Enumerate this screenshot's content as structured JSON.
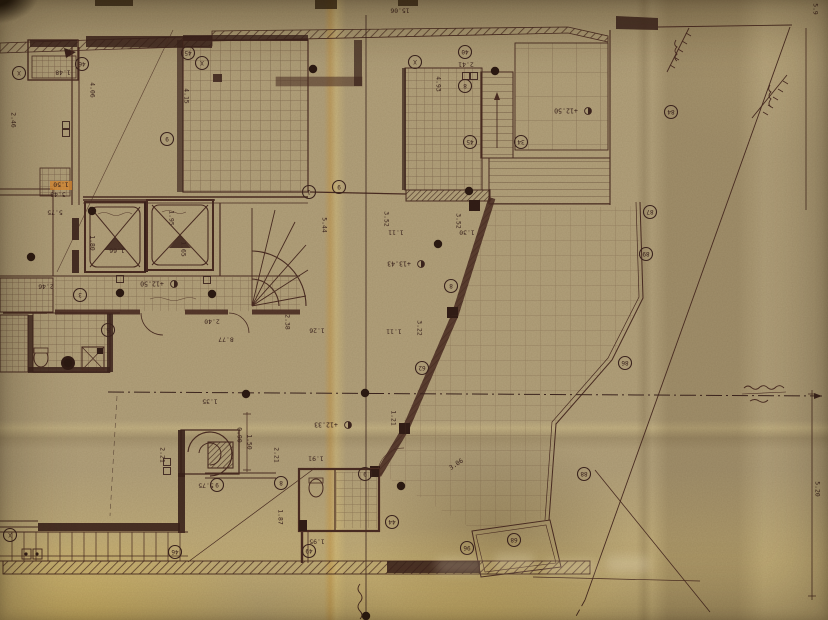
{
  "document": {
    "kind": "photographed architectural floor-plan blueprint on aged paper",
    "note": "plan annotations appear rotated (drawing photographed upside-down)"
  },
  "palette": {
    "paper": "#b2a17b",
    "paper_bright": "#e6c95e",
    "ink": "#4a2c22",
    "ink_dark": "#321d16",
    "highlight_orange": "#df8b2c"
  },
  "levels": [
    {
      "t": "+12.50",
      "x": 566,
      "y": 111,
      "r": 180
    },
    {
      "t": "+13.43",
      "x": 399,
      "y": 264,
      "r": 180
    },
    {
      "t": "+12.33",
      "x": 326,
      "y": 425,
      "r": 180
    },
    {
      "t": "+12.50",
      "x": 152,
      "y": 284,
      "r": 180
    }
  ],
  "dimensions": [
    {
      "t": "15.06",
      "x": 400,
      "y": 11,
      "r": 180
    },
    {
      "t": "1.48",
      "x": 63,
      "y": 73,
      "r": 180
    },
    {
      "t": "2.46",
      "x": 14,
      "y": 120,
      "r": 90
    },
    {
      "t": "4.06",
      "x": 93,
      "y": 90,
      "r": 90
    },
    {
      "t": "1.50",
      "x": 61,
      "y": 185,
      "r": 180,
      "hl": true
    },
    {
      "t": "3.48",
      "x": 58,
      "y": 195,
      "r": 180
    },
    {
      "t": "5.75",
      "x": 55,
      "y": 213,
      "r": 180
    },
    {
      "t": "2.46",
      "x": 46,
      "y": 287,
      "r": 180
    },
    {
      "t": "4.15",
      "x": 187,
      "y": 96,
      "r": 90
    },
    {
      "t": "2.41",
      "x": 466,
      "y": 65,
      "r": 180
    },
    {
      "t": "4.93",
      "x": 439,
      "y": 84,
      "r": 90
    },
    {
      "t": "3.52",
      "x": 387,
      "y": 219,
      "r": 90
    },
    {
      "t": "1.11",
      "x": 396,
      "y": 233,
      "r": 180
    },
    {
      "t": "3.52",
      "x": 459,
      "y": 221,
      "r": 90
    },
    {
      "t": "1.30",
      "x": 467,
      "y": 233,
      "r": 180
    },
    {
      "t": "5.44",
      "x": 325,
      "y": 225,
      "r": 90
    },
    {
      "t": "2.38",
      "x": 288,
      "y": 322,
      "r": 90
    },
    {
      "t": "1.26",
      "x": 317,
      "y": 331,
      "r": 180
    },
    {
      "t": "3.22",
      "x": 420,
      "y": 328,
      "r": 90
    },
    {
      "t": "1.11",
      "x": 394,
      "y": 332,
      "r": 180
    },
    {
      "t": "2.40",
      "x": 212,
      "y": 322,
      "r": 180
    },
    {
      "t": "8.77",
      "x": 226,
      "y": 340,
      "r": 180
    },
    {
      "t": "1.95",
      "x": 172,
      "y": 218,
      "r": 90
    },
    {
      "t": "1.65",
      "x": 184,
      "y": 249,
      "r": 90
    },
    {
      "t": "1.80",
      "x": 93,
      "y": 243,
      "r": 90
    },
    {
      "t": "1.66",
      "x": 117,
      "y": 251,
      "r": 180
    },
    {
      "t": "0.90",
      "x": 240,
      "y": 435,
      "r": 90
    },
    {
      "t": "1.35",
      "x": 210,
      "y": 402,
      "r": 180
    },
    {
      "t": "2.21",
      "x": 163,
      "y": 455,
      "r": 90
    },
    {
      "t": "2.21",
      "x": 277,
      "y": 455,
      "r": 90
    },
    {
      "t": "1.50",
      "x": 250,
      "y": 442,
      "r": 90
    },
    {
      "t": "5.75",
      "x": 206,
      "y": 486,
      "r": 180
    },
    {
      "t": "1.87",
      "x": 281,
      "y": 517,
      "r": 90
    },
    {
      "t": "1.91",
      "x": 316,
      "y": 459,
      "r": 180
    },
    {
      "t": "1.95",
      "x": 317,
      "y": 542,
      "r": 180
    },
    {
      "t": "3.06",
      "x": 456,
      "y": 464,
      "r": -34
    },
    {
      "t": "1.21",
      "x": 394,
      "y": 418,
      "r": 90
    },
    {
      "t": "5.20",
      "x": 818,
      "y": 489,
      "r": 90
    },
    {
      "t": "5.9",
      "x": 816,
      "y": 9,
      "r": 90
    }
  ],
  "circled_marks": [
    {
      "l": "X",
      "x": 19,
      "y": 73
    },
    {
      "l": "46",
      "x": 82,
      "y": 64
    },
    {
      "l": "45",
      "x": 188,
      "y": 53
    },
    {
      "l": "X",
      "x": 202,
      "y": 63
    },
    {
      "l": "9",
      "x": 167,
      "y": 139
    },
    {
      "l": "1",
      "x": 309,
      "y": 192
    },
    {
      "l": "9",
      "x": 339,
      "y": 187
    },
    {
      "l": "X",
      "x": 415,
      "y": 62
    },
    {
      "l": "40",
      "x": 465,
      "y": 52
    },
    {
      "l": "8",
      "x": 465,
      "y": 86
    },
    {
      "l": "45",
      "x": 470,
      "y": 142
    },
    {
      "l": "34",
      "x": 521,
      "y": 142
    },
    {
      "l": "84",
      "x": 671,
      "y": 112
    },
    {
      "l": "87",
      "x": 650,
      "y": 212
    },
    {
      "l": "89",
      "x": 646,
      "y": 254
    },
    {
      "l": "86",
      "x": 625,
      "y": 363
    },
    {
      "l": "88",
      "x": 584,
      "y": 474
    },
    {
      "l": "8",
      "x": 451,
      "y": 286
    },
    {
      "l": "62",
      "x": 422,
      "y": 368
    },
    {
      "l": "3",
      "x": 80,
      "y": 295
    },
    {
      "l": "5",
      "x": 108,
      "y": 330
    },
    {
      "l": "9",
      "x": 365,
      "y": 474
    },
    {
      "l": "44",
      "x": 392,
      "y": 522
    },
    {
      "l": "9",
      "x": 217,
      "y": 485
    },
    {
      "l": "8",
      "x": 281,
      "y": 483
    },
    {
      "l": "46",
      "x": 175,
      "y": 552
    },
    {
      "l": "49",
      "x": 309,
      "y": 551
    },
    {
      "l": "96",
      "x": 467,
      "y": 548
    },
    {
      "l": "68",
      "x": 514,
      "y": 540
    },
    {
      "l": "X",
      "x": 10,
      "y": 535
    }
  ],
  "square_marks": [
    {
      "x": 66,
      "y": 125
    },
    {
      "x": 66,
      "y": 133
    },
    {
      "x": 167,
      "y": 462
    },
    {
      "x": 167,
      "y": 471
    },
    {
      "x": 466,
      "y": 76
    },
    {
      "x": 474,
      "y": 76
    },
    {
      "x": 120,
      "y": 279
    },
    {
      "x": 207,
      "y": 280
    }
  ],
  "axis_dots": [
    {
      "x": 313,
      "y": 69
    },
    {
      "x": 495,
      "y": 71
    },
    {
      "x": 469,
      "y": 191
    },
    {
      "x": 438,
      "y": 244
    },
    {
      "x": 92,
      "y": 211
    },
    {
      "x": 31,
      "y": 257
    },
    {
      "x": 120,
      "y": 293
    },
    {
      "x": 212,
      "y": 294
    },
    {
      "x": 246,
      "y": 394
    },
    {
      "x": 365,
      "y": 393
    },
    {
      "x": 401,
      "y": 486
    },
    {
      "x": 68,
      "y": 363
    },
    {
      "x": 366,
      "y": 616
    }
  ]
}
